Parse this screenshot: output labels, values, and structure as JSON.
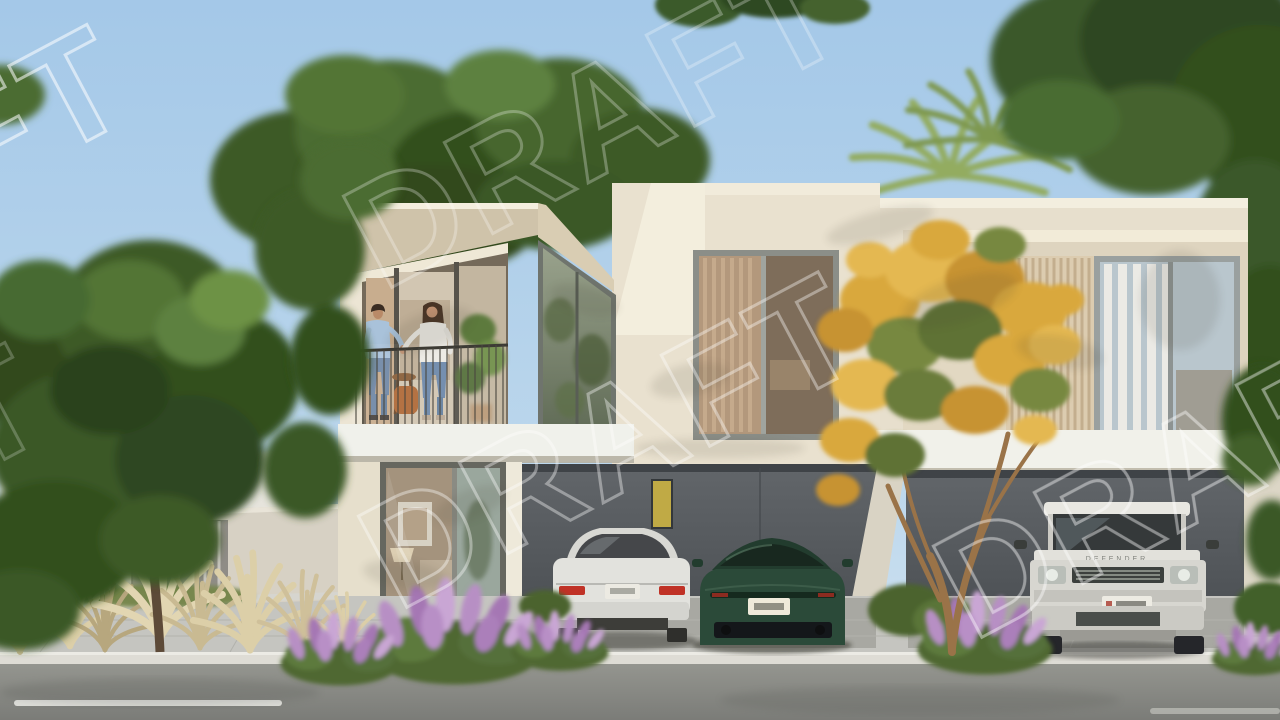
{
  "image": {
    "kind": "architectural-render",
    "subject": "Modern two-storey cream townhouses with carports, balcony couple, street landscaping",
    "time_of_day": "day"
  },
  "watermark": {
    "text": "DRAFT",
    "style": "outlined, rotated, tiled"
  },
  "vehicles": {
    "sedan": {
      "color": "white",
      "view": "rear"
    },
    "sports_car": {
      "color": "dark green",
      "view": "rear"
    },
    "suv": {
      "color": "white",
      "view": "front",
      "hood_label": "DEFENDER"
    }
  },
  "people": {
    "balcony": [
      "man in light blue shirt",
      "woman in white top"
    ],
    "background": [
      "distant pedestrian on left walkway"
    ]
  },
  "landscape": {
    "trees": [
      "large green tree left",
      "canopy over left roof",
      "palm cluster behind roof",
      "yellow-flowering tree right",
      "dark canopy top right"
    ],
    "plants": [
      "tan pampas grass tufts",
      "purple butterfly-bush blooms",
      "round green hedges"
    ]
  },
  "palette": {
    "sky_top": "#a4c8e8",
    "sky_low": "#cfe2f1",
    "facade": "#e8e1d0",
    "facade_bright": "#f3eedd",
    "soffit": "#cfc3aa",
    "carport": "#565b5f",
    "slab": "#f0f1ea",
    "paving": "#c5c5c0",
    "curb": "#dedcd5",
    "road": "#8b8c89",
    "foliage_dark": "#33501f",
    "foliage_light": "#6d9245",
    "flower_yellow": "#d9a83c",
    "flower_purple": "#b38bbf",
    "grass_plume": "#d9cba6",
    "curtain_tan": "#c8ad8e"
  }
}
